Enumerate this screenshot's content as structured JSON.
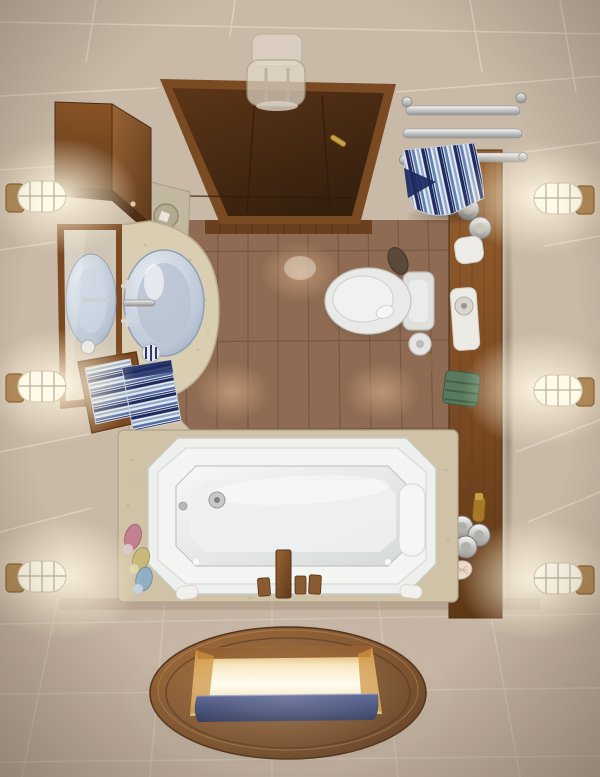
{
  "scene": {
    "type": "3d-render-photo",
    "view": "top-down small bathroom",
    "objects": [
      "ceiling-glass-lamp",
      "wood-entry-door",
      "wall-cabinet",
      "stone-pedestal",
      "vanity-mirror",
      "vessel-sink-vanity",
      "striped-towels",
      "chrome-towel-rack",
      "hanging-striped-towel",
      "wood-shelf-bench",
      "candles",
      "soap-dish",
      "amenity-tray",
      "green-towel",
      "amber-bottle",
      "silver-jars",
      "seashell",
      "toilet",
      "toilet-paper-holder",
      "bathtub",
      "wooden-bath-faucet",
      "bath-bottles",
      "soap-bars",
      "wall-sconces",
      "oval-floor-window"
    ]
  },
  "palette": {
    "wall": "#c9b9a7",
    "wall_line": "#ece2d2",
    "floor": "#c6b5a4",
    "floor_line": "#d8cbbb",
    "brown_tile": "#8e6b52",
    "brown_grout": "#6a503c",
    "wood": "#7c4a22",
    "wood_dark": "#4a2c15",
    "wood_light": "#9a6434",
    "door_frame": "#7a4a22",
    "stone_counter": "#d9cdb2",
    "stone_deck": "#cfc2a6",
    "tub_white": "#eef0ee",
    "tub_rim": "#c9cdc9",
    "basin": "#e2e6e5",
    "porcelain": "#e9eae8",
    "glass_sink": "#b9c3d2",
    "chrome": "#cfcfcf",
    "towel_navy": "#1c2a60",
    "towel_blue": "#8fa8c8",
    "towel_white": "#e8ecf0",
    "towel_green": "#5a7a5e",
    "gold_glow": "#f5c56a",
    "water_blue": "#2a3564",
    "lamp_glow": "#fff6e0",
    "sconce_base": "#b08a58",
    "bottle_pink": "#c28090",
    "bottle_yellow": "#c5b878",
    "bottle_blue": "#92aec2",
    "amber": "#a87828",
    "mirror_reflection": "#cfc5b4"
  }
}
